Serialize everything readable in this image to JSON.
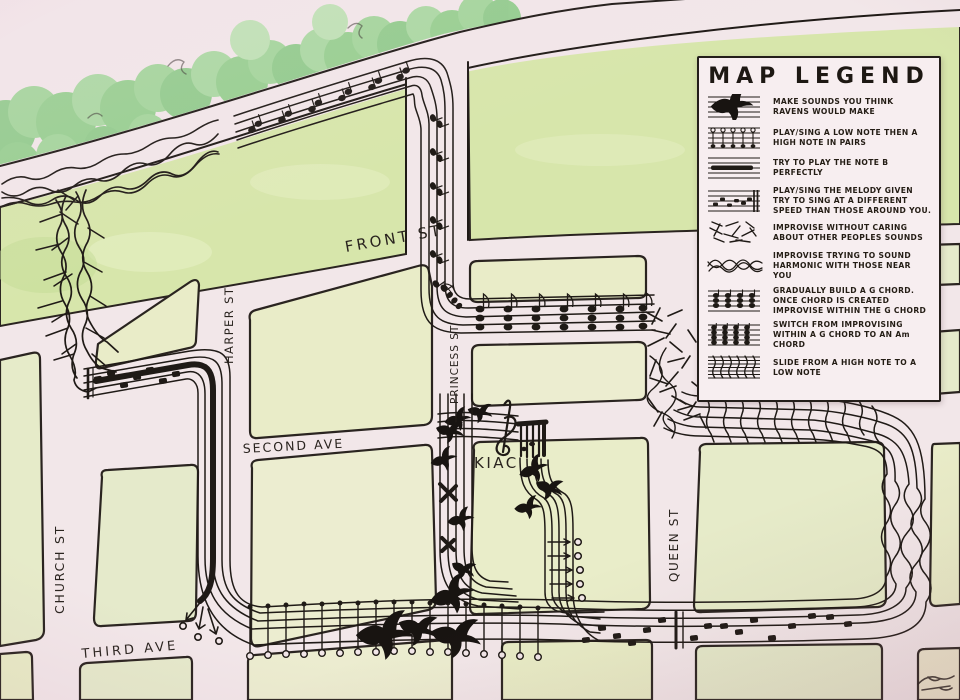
{
  "legend": {
    "title": "MAP LEGEND",
    "items": [
      {
        "icon": "raven-sounds-icon",
        "text": "MAKE SOUNDS YOU THINK RAVENS WOULD MAKE"
      },
      {
        "icon": "low-high-pairs-icon",
        "text": "PLAY/SING A LOW NOTE THEN A HIGH NOTE IN PAIRS"
      },
      {
        "icon": "note-b-icon",
        "text": "TRY TO PLAY THE NOTE B PERFECTLY"
      },
      {
        "icon": "melody-icon",
        "text": "PLAY/SING THE MELODY GIVEN TRY TO SING AT A DIFFERENT SPEED THAN THOSE AROUND YOU."
      },
      {
        "icon": "free-improv-icon",
        "text": "IMPROVISE WITHOUT CARING ABOUT OTHER PEOPLES SOUNDS"
      },
      {
        "icon": "harmonic-improv-icon",
        "text": "IMPROVISE TRYING TO SOUND HARMONIC WITH THOSE NEAR YOU"
      },
      {
        "icon": "g-chord-icon",
        "text": "GRADUALLY BUILD A G CHORD. ONCE CHORD IS CREATED IMPROVISE WITHIN THE G CHORD"
      },
      {
        "icon": "g-to-am-chord-icon",
        "text": "SWITCH FROM IMPROVISING WITHIN A G CHORD TO AN Am CHORD"
      },
      {
        "icon": "slide-icon",
        "text": "SLIDE FROM A HIGH NOTE TO A LOW NOTE"
      }
    ]
  },
  "map": {
    "streets": [
      {
        "name": "FRONT ST"
      },
      {
        "name": "SECOND AVE"
      },
      {
        "name": "THIRD AVE"
      },
      {
        "name": "CHURCH ST"
      },
      {
        "name": "HARPER ST"
      },
      {
        "name": "PRINCESS ST"
      },
      {
        "name": "QUEEN ST"
      }
    ],
    "landmarks": [
      {
        "name": "KIAC"
      }
    ]
  },
  "colors": {
    "paper": "#f2e7e9",
    "ink": "#1f1a16",
    "block": "#e9ecc8",
    "park": "#d7e6ab",
    "trees": "#8bcc85",
    "legend_bg": "#f7eef0"
  }
}
